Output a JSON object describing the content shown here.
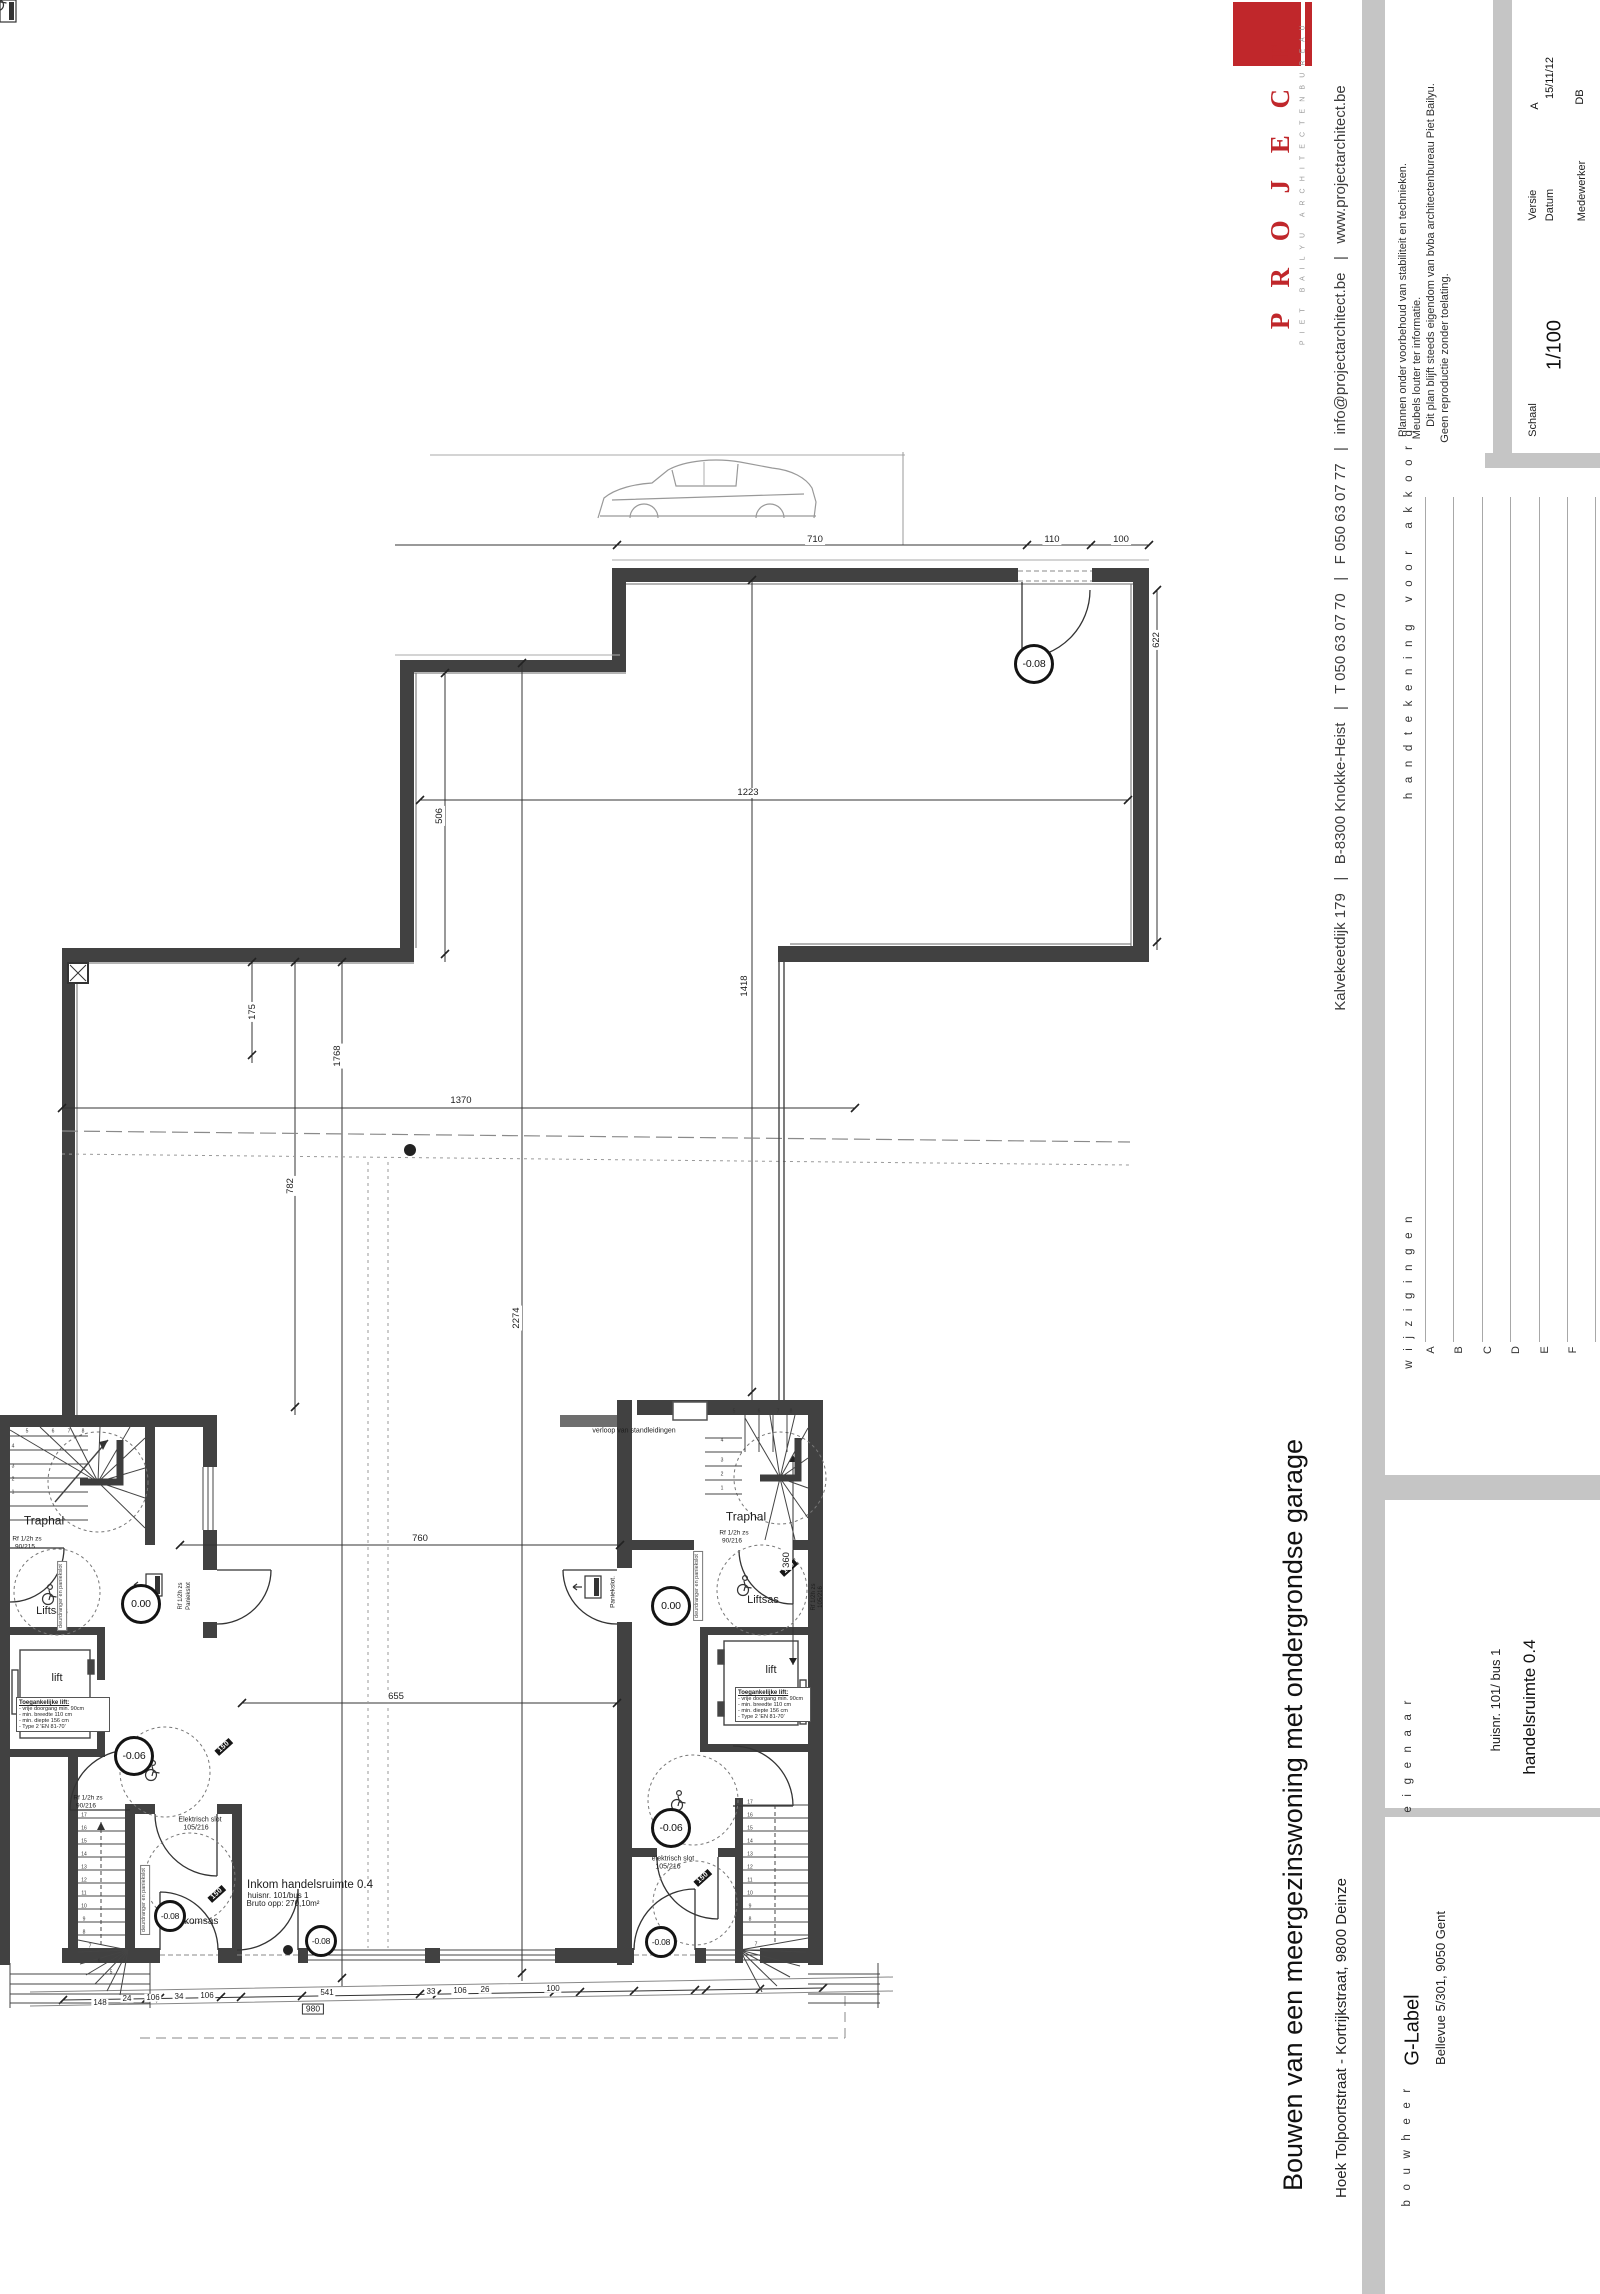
{
  "title_block": {
    "logo_name": "P R O J E C T",
    "logo_tagline": "P I E T   B A I L Y U   A R C H I T E C T E N B U R E A U",
    "contact": "Kalvekeetdijk 179   |   B-8300 Knokke-Heist   |   T 050 63 07 70   |   F 050 63 07 77   |   info@projectarchitect.be   |   www.projectarchitect.be",
    "disclaimer": [
      "Plannen onder voorbehoud van stabiliteit en technieken.",
      "Meubels louter ter informatie.",
      "Dit plan blijft steeds eigendom van bvba architectenbureau Piet Bailyu.",
      "Geen reproductie zonder toelating."
    ],
    "versie_label": "Versie",
    "versie": "A",
    "datum_label": "Datum",
    "datum": "15/11/12",
    "medewerker_label": "Medewerker",
    "medewerker": "DB",
    "schaal_label": "Schaal",
    "schaal": "1/100",
    "signature_label": "h a n d t e k e n i n g   v o o r   a k k o o r d",
    "wijzigingen_label": "w i j z i g i n g e n",
    "revision_letters": [
      "A",
      "B",
      "C",
      "D",
      "E",
      "F"
    ],
    "eigenaar_label": "e i g e n a a r",
    "bou wheer_note": "",
    "bouwheer_label": "b o u w h e e r",
    "bouwheer_name": "G-Label",
    "bouwheer_address": "Bellevue 5/301, 9050 Gent",
    "project_title": "Bouwen van een meergezinswoning met ondergrondse garage",
    "project_address": "Hoek Tolpoortstraat - Kortrijkstraat, 9800 Deinze",
    "sheet_number": "huisnr. 101/ bus 1",
    "sheet_name": "handelsruimte 0.4"
  },
  "plan": {
    "scale_note": "1/100",
    "lift_spec": [
      "Toegankelijke lift:",
      "- vrije doorgang min. 90cm",
      "- min. breedte 110 cm",
      "- min. diepte 156 cm",
      "- Type 2 'EN 81-70'"
    ],
    "lift_spec_boxes": [
      {
        "x": 16,
        "y": 1697,
        "w": 88
      },
      {
        "x": 735,
        "y": 1687,
        "w": 70
      }
    ],
    "levels": [
      {
        "t": "-0.08",
        "x": 1034,
        "y": 664,
        "d": 34
      },
      {
        "t": "0.00",
        "x": 141,
        "y": 1604,
        "d": 34
      },
      {
        "t": "0.00",
        "x": 671,
        "y": 1606,
        "d": 34
      },
      {
        "t": "-0.06",
        "x": 134,
        "y": 1756,
        "d": 34
      },
      {
        "t": "-0.06",
        "x": 671,
        "y": 1828,
        "d": 34
      },
      {
        "t": "-0.08",
        "x": 170,
        "y": 1916,
        "d": 26
      },
      {
        "t": "-0.08",
        "x": 321,
        "y": 1941,
        "d": 26
      },
      {
        "t": "-0.08",
        "x": 661,
        "y": 1942,
        "d": 26
      }
    ],
    "texts": [
      {
        "t": "Traphal",
        "x": 44,
        "y": 1521,
        "s": 12
      },
      {
        "t": "Traphal",
        "x": 746,
        "y": 1517,
        "s": 12
      },
      {
        "t": "Liftsas",
        "x": 52,
        "y": 1612,
        "s": 11
      },
      {
        "t": "Liftsas",
        "x": 763,
        "y": 1601,
        "s": 11
      },
      {
        "t": "lift",
        "x": 57,
        "y": 1679,
        "s": 11
      },
      {
        "t": "lift",
        "x": 771,
        "y": 1671,
        "s": 11
      },
      {
        "t": "Inkomsas",
        "x": 197,
        "y": 1922,
        "s": 10
      },
      {
        "t": "Inkom handelsruimte 0.4",
        "x": 310,
        "y": 1885,
        "s": 11.5
      },
      {
        "t": "huisnr. 101/bus 1",
        "x": 278,
        "y": 1896,
        "s": 8
      },
      {
        "t": "Bruto opp: 270,10m²",
        "x": 283,
        "y": 1904,
        "s": 8
      },
      {
        "t": "Rf 1/2h zs",
        "x": 27,
        "y": 1540,
        "s": 6.5
      },
      {
        "t": "90/215",
        "x": 25,
        "y": 1548,
        "s": 6.5
      },
      {
        "t": "Rf 1/2h zs",
        "x": 88,
        "y": 1799,
        "s": 6.5
      },
      {
        "t": "90/216",
        "x": 86,
        "y": 1807,
        "s": 6.5
      },
      {
        "t": "Rf 1/2h zs",
        "x": 734,
        "y": 1534,
        "s": 6.5
      },
      {
        "t": "90/216",
        "x": 732,
        "y": 1542,
        "s": 6.5
      },
      {
        "t": "Elektrisch slot",
        "x": 200,
        "y": 1820,
        "s": 7
      },
      {
        "t": "105/216",
        "x": 196,
        "y": 1828,
        "s": 7
      },
      {
        "t": "elektrisch slot",
        "x": 673,
        "y": 1859,
        "s": 7
      },
      {
        "t": "105/216",
        "x": 668,
        "y": 1867,
        "s": 7
      },
      {
        "t": "Paniekslot.",
        "x": 614,
        "y": 1592,
        "s": 6.5,
        "r": -90
      },
      {
        "t": "Rf 1/2h zs",
        "x": 181,
        "y": 1596,
        "s": 6,
        "r": -90
      },
      {
        "t": "Paniekslot",
        "x": 189,
        "y": 1596,
        "s": 6,
        "r": -90
      },
      {
        "t": "Rf 1/2h zs",
        "x": 814,
        "y": 1597,
        "s": 6,
        "r": -90
      },
      {
        "t": "105/216",
        "x": 821,
        "y": 1597,
        "s": 6,
        "r": -90
      },
      {
        "t": "verloop van standleidingen",
        "x": 634,
        "y": 1431,
        "s": 7
      },
      {
        "t": "deurdranger en paniekslot",
        "x": 62,
        "y": 1596,
        "s": 5.5,
        "r": -90,
        "cls": "notebox"
      },
      {
        "t": "deurdranger en paniekslot",
        "x": 145,
        "y": 1900,
        "s": 5.5,
        "r": -90,
        "cls": "notebox"
      },
      {
        "t": "deurdranger en paniekslot",
        "x": 698,
        "y": 1586,
        "s": 5.5,
        "r": -90,
        "cls": "notebox"
      },
      {
        "t": "150",
        "x": 224,
        "y": 1747,
        "s": 7,
        "r": -42,
        "cls": "mark"
      },
      {
        "t": "150",
        "x": 217,
        "y": 1894,
        "s": 7,
        "r": -42,
        "cls": "mark"
      },
      {
        "t": "150",
        "x": 789,
        "y": 1568,
        "s": 7,
        "r": -42,
        "cls": "mark"
      },
      {
        "t": "150",
        "x": 703,
        "y": 1878,
        "s": 7,
        "r": -42,
        "cls": "mark"
      },
      {
        "t": "710",
        "x": 815,
        "y": 540,
        "s": 9.5,
        "cls": "dim"
      },
      {
        "t": "110",
        "x": 1052,
        "y": 540,
        "s": 9.5,
        "cls": "dim"
      },
      {
        "t": "100",
        "x": 1121,
        "y": 540,
        "s": 9.5,
        "cls": "dim"
      },
      {
        "t": "1223",
        "x": 748,
        "y": 793,
        "s": 9.5,
        "cls": "dim"
      },
      {
        "t": "506",
        "x": 440,
        "y": 816,
        "s": 9.5,
        "r": -90,
        "cls": "dim"
      },
      {
        "t": "622",
        "x": 1157,
        "y": 640,
        "s": 9.5,
        "r": -90,
        "cls": "dim"
      },
      {
        "t": "1418",
        "x": 745,
        "y": 986,
        "s": 9.5,
        "r": -90,
        "cls": "dim"
      },
      {
        "t": "1370",
        "x": 461,
        "y": 1101,
        "s": 9.5,
        "cls": "dim"
      },
      {
        "t": "782",
        "x": 291,
        "y": 1186,
        "s": 9.5,
        "r": -90,
        "cls": "dim"
      },
      {
        "t": "2274",
        "x": 517,
        "y": 1318,
        "s": 9.5,
        "r": -90,
        "cls": "dim"
      },
      {
        "t": "1768",
        "x": 338,
        "y": 1056,
        "s": 9.5,
        "r": -90,
        "cls": "dim"
      },
      {
        "t": "175",
        "x": 253,
        "y": 1012,
        "s": 9.5,
        "r": -90,
        "cls": "dim"
      },
      {
        "t": "360",
        "x": 787,
        "y": 1560,
        "s": 9.5,
        "r": -90,
        "cls": "dim"
      },
      {
        "t": "760",
        "x": 420,
        "y": 1539,
        "s": 9.5,
        "cls": "dim"
      },
      {
        "t": "655",
        "x": 396,
        "y": 1697,
        "s": 9.5,
        "cls": "dim"
      },
      {
        "t": "148",
        "x": 100,
        "y": 2003,
        "s": 8,
        "cls": "dim"
      },
      {
        "t": "24",
        "x": 127,
        "y": 1999,
        "s": 8,
        "cls": "dim"
      },
      {
        "t": "106",
        "x": 153,
        "y": 1998,
        "s": 8,
        "cls": "dim"
      },
      {
        "t": "34",
        "x": 179,
        "y": 1997,
        "s": 8,
        "cls": "dim"
      },
      {
        "t": "106",
        "x": 207,
        "y": 1996,
        "s": 8,
        "cls": "dim"
      },
      {
        "t": "541",
        "x": 327,
        "y": 1993,
        "s": 8,
        "cls": "dim"
      },
      {
        "t": "33",
        "x": 431,
        "y": 1992,
        "s": 8,
        "cls": "dim"
      },
      {
        "t": "106",
        "x": 460,
        "y": 1991,
        "s": 8,
        "cls": "dim"
      },
      {
        "t": "26",
        "x": 485,
        "y": 1990,
        "s": 8,
        "cls": "dim"
      },
      {
        "t": "100",
        "x": 553,
        "y": 1989,
        "s": 8,
        "cls": "dim"
      },
      {
        "t": "980",
        "x": 313,
        "y": 2009,
        "s": 8.5,
        "cls": "dimbox"
      },
      {
        "t": "17",
        "x": 84,
        "y": 1816,
        "s": 5,
        "cls": "stepnum"
      },
      {
        "t": "16",
        "x": 84,
        "y": 1829,
        "s": 5,
        "cls": "stepnum"
      },
      {
        "t": "15",
        "x": 84,
        "y": 1842,
        "s": 5,
        "cls": "stepnum"
      },
      {
        "t": "14",
        "x": 84,
        "y": 1855,
        "s": 5,
        "cls": "stepnum"
      },
      {
        "t": "13",
        "x": 84,
        "y": 1868,
        "s": 5,
        "cls": "stepnum"
      },
      {
        "t": "12",
        "x": 84,
        "y": 1881,
        "s": 5,
        "cls": "stepnum"
      },
      {
        "t": "11",
        "x": 84,
        "y": 1894,
        "s": 5,
        "cls": "stepnum"
      },
      {
        "t": "10",
        "x": 84,
        "y": 1907,
        "s": 5,
        "cls": "stepnum"
      },
      {
        "t": "9",
        "x": 84,
        "y": 1920,
        "s": 5,
        "cls": "stepnum"
      },
      {
        "t": "8",
        "x": 84,
        "y": 1933,
        "s": 5,
        "cls": "stepnum"
      },
      {
        "t": "7",
        "x": 90,
        "y": 1947,
        "s": 5,
        "cls": "stepnum"
      },
      {
        "t": "6",
        "x": 99,
        "y": 1962,
        "s": 5,
        "cls": "stepnum"
      },
      {
        "t": "5",
        "x": 111,
        "y": 1973,
        "s": 5,
        "cls": "stepnum"
      },
      {
        "t": "17",
        "x": 750,
        "y": 1803,
        "s": 5,
        "cls": "stepnum"
      },
      {
        "t": "16",
        "x": 750,
        "y": 1816,
        "s": 5,
        "cls": "stepnum"
      },
      {
        "t": "15",
        "x": 750,
        "y": 1829,
        "s": 5,
        "cls": "stepnum"
      },
      {
        "t": "14",
        "x": 750,
        "y": 1842,
        "s": 5,
        "cls": "stepnum"
      },
      {
        "t": "13",
        "x": 750,
        "y": 1855,
        "s": 5,
        "cls": "stepnum"
      },
      {
        "t": "12",
        "x": 750,
        "y": 1868,
        "s": 5,
        "cls": "stepnum"
      },
      {
        "t": "11",
        "x": 750,
        "y": 1881,
        "s": 5,
        "cls": "stepnum"
      },
      {
        "t": "10",
        "x": 750,
        "y": 1894,
        "s": 5,
        "cls": "stepnum"
      },
      {
        "t": "9",
        "x": 750,
        "y": 1907,
        "s": 5,
        "cls": "stepnum"
      },
      {
        "t": "8",
        "x": 750,
        "y": 1920,
        "s": 5,
        "cls": "stepnum"
      },
      {
        "t": "7",
        "x": 756,
        "y": 1945,
        "s": 5,
        "cls": "stepnum"
      },
      {
        "t": "1",
        "x": 13,
        "y": 1493,
        "s": 5,
        "cls": "stepnum"
      },
      {
        "t": "2",
        "x": 13,
        "y": 1480,
        "s": 5,
        "cls": "stepnum"
      },
      {
        "t": "3",
        "x": 13,
        "y": 1467,
        "s": 5,
        "cls": "stepnum"
      },
      {
        "t": "4",
        "x": 13,
        "y": 1447,
        "s": 5,
        "cls": "stepnum"
      },
      {
        "t": "5",
        "x": 27,
        "y": 1432,
        "s": 5,
        "cls": "stepnum"
      },
      {
        "t": "6",
        "x": 53,
        "y": 1432,
        "s": 5,
        "cls": "stepnum"
      },
      {
        "t": "7",
        "x": 69,
        "y": 1432,
        "s": 5,
        "cls": "stepnum"
      },
      {
        "t": "8",
        "x": 83,
        "y": 1432,
        "s": 5,
        "cls": "stepnum"
      },
      {
        "t": "1",
        "x": 722,
        "y": 1489,
        "s": 5,
        "cls": "stepnum"
      },
      {
        "t": "2",
        "x": 722,
        "y": 1475,
        "s": 5,
        "cls": "stepnum"
      },
      {
        "t": "3",
        "x": 722,
        "y": 1461,
        "s": 5,
        "cls": "stepnum"
      },
      {
        "t": "4",
        "x": 722,
        "y": 1441,
        "s": 5,
        "cls": "stepnum"
      },
      {
        "t": "5",
        "x": 734,
        "y": 1412,
        "s": 5,
        "cls": "stepnum"
      },
      {
        "t": "6",
        "x": 759,
        "y": 1412,
        "s": 5,
        "cls": "stepnum"
      },
      {
        "t": "7",
        "x": 778,
        "y": 1412,
        "s": 5,
        "cls": "stepnum"
      },
      {
        "t": "8",
        "x": 791,
        "y": 1412,
        "s": 5,
        "cls": "stepnum"
      }
    ]
  }
}
